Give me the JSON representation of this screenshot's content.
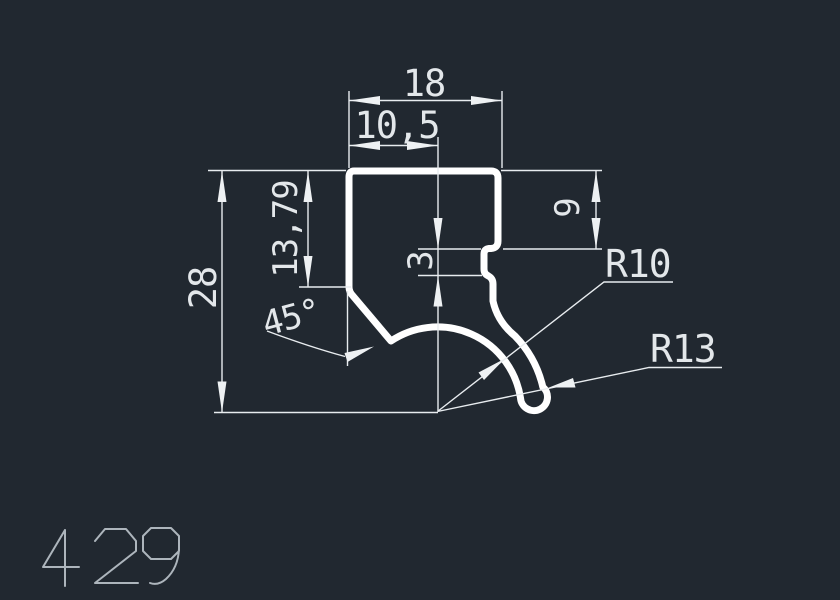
{
  "part": {
    "number": "429"
  },
  "dimensions": {
    "width_outer": "18",
    "width_inner": "10,5",
    "height_outer": "28",
    "height_mid": "13,79",
    "notch_depth": "3",
    "right_step_height": "9",
    "chamfer_angle": "45°",
    "radius_inner": "R10",
    "radius_outer": "R13"
  },
  "colors": {
    "background": "#212830",
    "profile_line": "#ffffff",
    "dimension_line": "#e8ecef",
    "dimension_text": "#e3e7ea",
    "part_label": "#adb5bc"
  }
}
